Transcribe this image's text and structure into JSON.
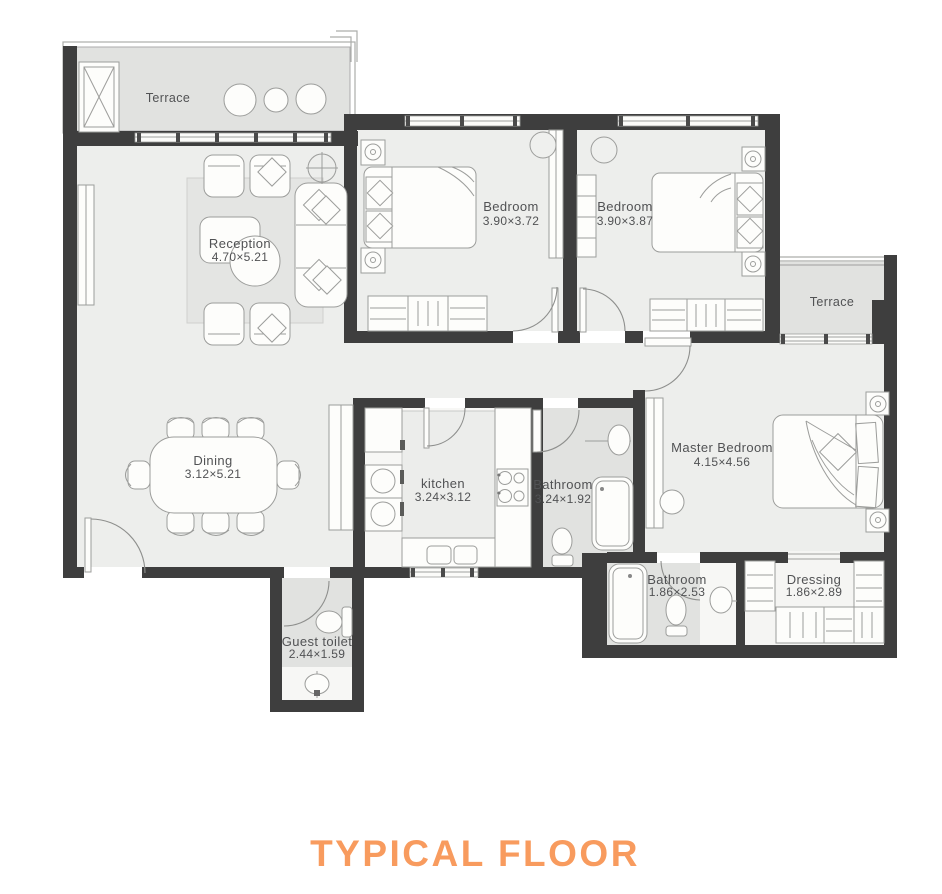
{
  "title": "TYPICAL FLOOR",
  "colors": {
    "accent": "#F89B5E",
    "wall": "#3E3E3E",
    "floor": "#EDEEEC",
    "wet": "#E1E2E0",
    "label": "#515254",
    "line": "#9C9D9B"
  },
  "rooms": {
    "terrace_left": {
      "name": "Terrace"
    },
    "reception": {
      "name": "Reception",
      "dims": "4.70×5.21"
    },
    "bedroom_1": {
      "name": "Bedroom",
      "dims": "3.90×3.72"
    },
    "bedroom_2": {
      "name": "Bedroom",
      "dims": "3.90×3.87"
    },
    "terrace_right": {
      "name": "Terrace"
    },
    "master_bedroom": {
      "name": "Master Bedroom",
      "dims": "4.15×4.56"
    },
    "dining": {
      "name": "Dining",
      "dims": "3.12×5.21"
    },
    "kitchen": {
      "name": "kitchen",
      "dims": "3.24×3.12"
    },
    "bathroom": {
      "name": "Bathroom",
      "dims": "3.24×1.92"
    },
    "master_bathroom": {
      "name": "Bathroom",
      "dims": "1.86×2.53"
    },
    "dressing": {
      "name": "Dressing",
      "dims": "1.86×2.89"
    },
    "guest_toilet": {
      "name": "Guest toilet",
      "dims": "2.44×1.59"
    }
  }
}
